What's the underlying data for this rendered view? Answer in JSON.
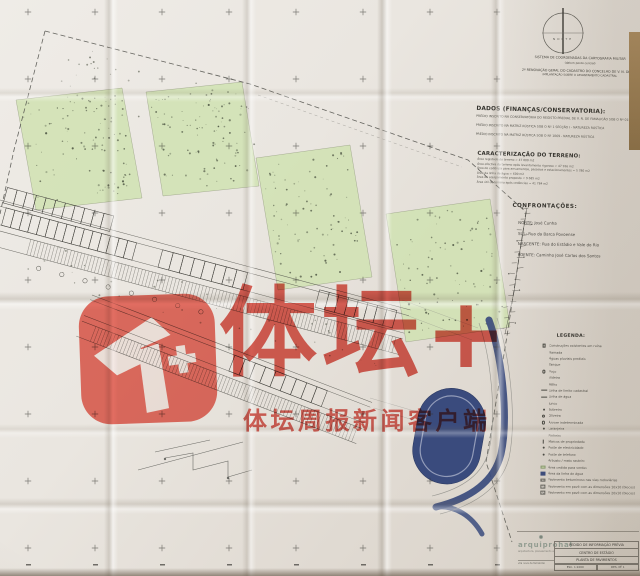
{
  "watermark": {
    "brand_text": "体坛+",
    "tagline": "体坛周报新闻客户端",
    "color": "#db483c",
    "icon": "titan-sports-plus-logo"
  },
  "compass": {
    "label": "NORTE"
  },
  "top_notes": {
    "line1": "SISTEMA DE COORDENADAS DA CARTOGRAFIA MILITAR",
    "line2": "(datum ponto central)",
    "line3": "2ª RENOVAÇÃO GERAL DO CADASTRO DO CONCELHO DE V. N. DE FAMALICÃO",
    "line4": "IMPLANTAÇÃO SOBRE O LEVANTAMENTO CADASTRAL"
  },
  "dados": {
    "title": "DADOS (FINANÇAS/CONSERVATORIA):",
    "lines": [
      "PRÉDIO INSCRITO NA CONSERVATÓRIA DO REGISTO PREDIAL DE V. N. DE FAMALICÃO SOB O Nº 01503/120495",
      "PRÉDIO INSCRITO NA MATRIZ RÚSTICA SOB O Nº 1 SECÇÃO I - NATUREZA RÚSTICA",
      "PRÉDIO INSCRITO NA MATRIZ RÚSTICA SOB O Nº 1069 - NATUREZA RÚSTICA"
    ]
  },
  "caracterizacao": {
    "title": "CARACTERIZAÇÃO DO TERRENO:",
    "lines": [
      "Área registada do terreno = 47 000 m2",
      "Área efectiva do terreno após levantamento rigoroso = 47 916 m2",
      "Área de cedência para arruamentos, passeios e estacionamentos = 5 780 m2",
      "Área da linha de água = 600 m2",
      "Área de equipamento proposto = 9 685 m2",
      "Área útil do terreno após cedências = 41 784 m2"
    ]
  },
  "confrontacoes": {
    "title": "CONFRONTAÇÕES:",
    "lines": [
      "NORTE: José Cunha",
      "SUL: Rua da Barca Povoense",
      "NASCENTE: Rua do Estádio e Vale do Rio",
      "POENTE: Caminho José Carlos dos Santos"
    ]
  },
  "legenda": {
    "title": "LEGENDA:",
    "items": [
      {
        "symbol": "square",
        "label": "Construções existentes em ruína"
      },
      {
        "symbol": "none",
        "label": "Ramada"
      },
      {
        "symbol": "none",
        "label": "Águas pluviais prediais"
      },
      {
        "symbol": "none",
        "label": "Tanque"
      },
      {
        "symbol": "circle",
        "label": "Poço"
      },
      {
        "symbol": "none",
        "label": "Videira"
      },
      {
        "symbol": "none",
        "label": "Milho"
      },
      {
        "symbol": "dash",
        "label": "Linha de limite cadastral"
      },
      {
        "symbol": "line",
        "label": "Linha de água"
      },
      {
        "symbol": "none",
        "label": "Junco"
      },
      {
        "symbol": "dot",
        "label": "Sobreiro"
      },
      {
        "symbol": "ring",
        "label": "Oliveira"
      },
      {
        "symbol": "circle",
        "label": "Árvore indeterminada"
      },
      {
        "symbol": "dot",
        "label": "Laranjeira"
      },
      {
        "symbol": "none",
        "label": "Pinheiro"
      },
      {
        "symbol": "tick",
        "label": "Marcos de propriedade"
      },
      {
        "symbol": "dot",
        "label": "Poste de electricidade"
      },
      {
        "symbol": "dot",
        "label": "Poste de telefone"
      },
      {
        "symbol": "none",
        "label": "Arbusto / mato rasteiro"
      },
      {
        "symbol": "green",
        "label": "Área cedida para verdes"
      },
      {
        "symbol": "blue",
        "label": "Área da linha de água"
      },
      {
        "symbol": "hatch",
        "label": "Pavimento betuminoso nas vias rodoviárias"
      },
      {
        "symbol": "hatch",
        "label": "Pavimento em pavê com as dimensões 10x10 (blocos)"
      },
      {
        "symbol": "hatch",
        "label": "Pavimento em pavê com as dimensões 20x10 (blocos)"
      }
    ]
  },
  "title_block": {
    "logo": "arquiprohal",
    "logo_tagline": "arquitectura, planeamento e urbanismo, lda.",
    "address": "vila nova de famalicão",
    "rows": [
      "PEDIDO DE INFORMAÇÃO PRÉVIA",
      "CENTRO DE ESTÁGIO",
      "PLANTA DE PAVIMENTOS"
    ],
    "footer_cells": [
      "ESC. 1:1000",
      "DES. Nº 1"
    ]
  },
  "plan_colors": {
    "parcel_green": "#d0e2b2",
    "stadium_navy": "#3a4b7d",
    "linework": "#4c4c46",
    "paper": "#e9e5df"
  }
}
